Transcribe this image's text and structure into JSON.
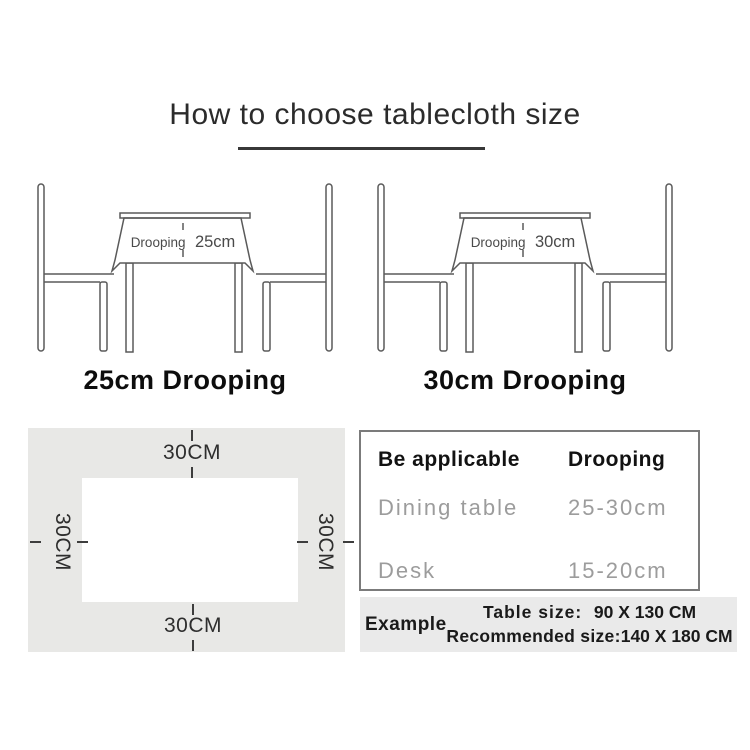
{
  "page": {
    "title": "How to choose tablecloth size"
  },
  "diagrams": [
    {
      "droop_word": "Drooping",
      "droop_value": "25cm",
      "caption": "25cm Drooping"
    },
    {
      "droop_word": "Drooping",
      "droop_value": "30cm",
      "caption": "30cm Drooping"
    }
  ],
  "margin_diagram": {
    "top_label": "30CM",
    "bottom_label": "30CM",
    "left_label": "30CM",
    "right_label": "30CM"
  },
  "spec_table": {
    "headers": {
      "col1": "Be applicable",
      "col2": "Drooping"
    },
    "rows": [
      {
        "name": "Dining table",
        "value": "25-30cm"
      },
      {
        "name": "Desk",
        "value": "15-20cm"
      }
    ]
  },
  "example": {
    "label": "Example",
    "line1_label": "Table size:",
    "line1_value": "90 X 130 CM",
    "line2_label": "Recommended size:",
    "line2_value": "140 X 180 CM"
  },
  "colors": {
    "line": "#5a5a5a",
    "cloth_background": "#e8e8e6",
    "example_background": "#eaeaea",
    "muted_text": "#9c9c9c",
    "heading_text": "#121212"
  }
}
